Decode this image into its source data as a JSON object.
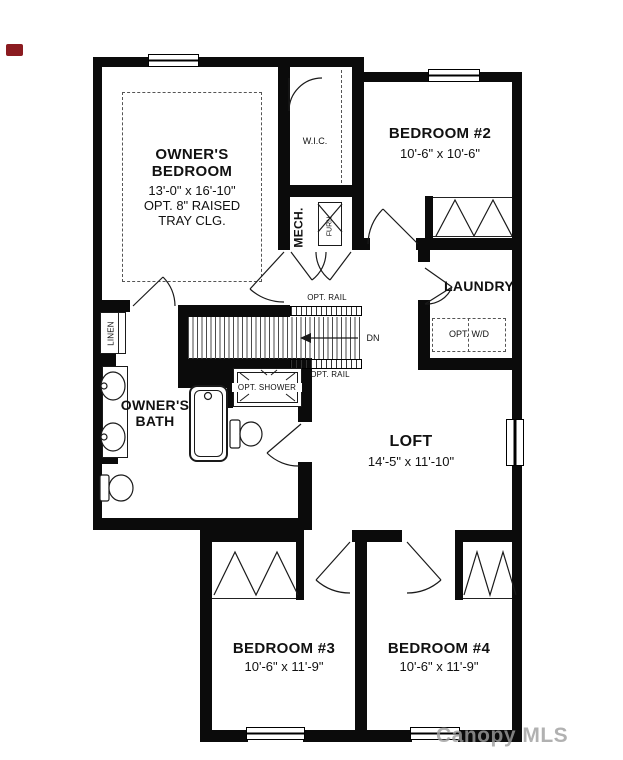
{
  "brand_mark": {
    "color": "#8b1b20"
  },
  "watermark": {
    "text": "Canopy MLS"
  },
  "labels": {
    "owners_bedroom": {
      "line1": "OWNER'S",
      "line2": "BEDROOM",
      "dims": "13'-0\" x 16'-10\"",
      "opt1": "OPT. 8\" RAISED",
      "opt2": "TRAY CLG."
    },
    "wic": "W.I.C.",
    "bedroom2": {
      "name": "BEDROOM #2",
      "dims": "10'-6\" x 10'-6\""
    },
    "mech": "MECH.",
    "furn": "FURN",
    "laundry": {
      "name": "LAUNDRY",
      "opt_wd": "OPT. W/D"
    },
    "stairs": {
      "opt_rail_top": "OPT. RAIL",
      "opt_rail_bottom": "OPT. RAIL",
      "dn": "DN"
    },
    "linen": "LINEN",
    "owners_bath": {
      "line1": "OWNER'S",
      "line2": "BATH"
    },
    "opt_shower": "OPT. SHOWER",
    "loft": {
      "name": "LOFT",
      "dims": "14'-5\" x 11'-10\""
    },
    "bedroom3": {
      "name": "BEDROOM #3",
      "dims": "10'-6\" x 11'-9\""
    },
    "bedroom4": {
      "name": "BEDROOM #4",
      "dims": "10'-6\" x 11'-9\""
    }
  }
}
